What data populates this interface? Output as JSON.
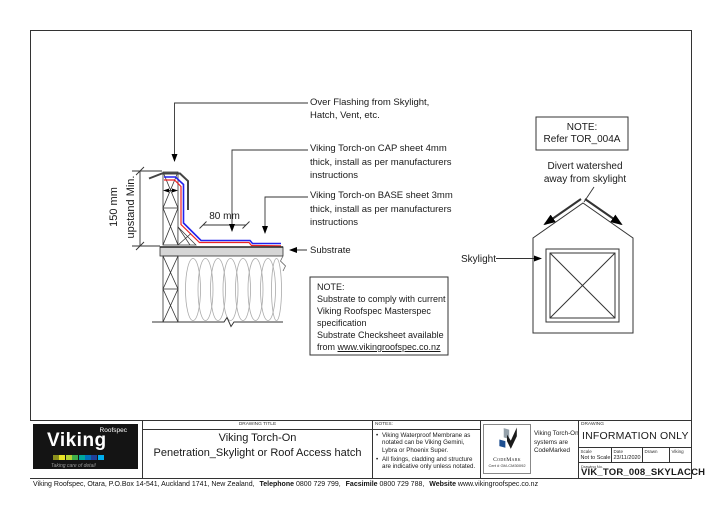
{
  "colors": {
    "cap_sheet": "#2222ee",
    "base_sheet": "#ee2222",
    "substrate": "#d6d6d6",
    "logo_bg": "#141414"
  },
  "section": {
    "dim_150": "150 mm",
    "dim_150_label": "upstand Min.",
    "dim_80": "80 mm",
    "ann_over_flashing": "Over Flashing from Skylight,\nHatch, Vent, etc.",
    "ann_cap": "Viking Torch-on CAP sheet 4mm\nthick, install as per manufacturers\ninstructions",
    "ann_base": "Viking Torch-on BASE sheet 3mm\nthick, install as per manufacturers\ninstructions",
    "ann_substrate": "Substrate",
    "note_box": {
      "body": "NOTE:\nSubstrate to comply with current\nViking Roofspec Masterspec\nspecification\nSubstrate Checksheet available",
      "last_line_prefix": "from ",
      "last_line_url": "www.vikingroofspec.co.nz"
    }
  },
  "plan": {
    "note_title": "NOTE:",
    "note_ref": "Refer TOR_004A",
    "divert": "Divert watershed\naway from skylight",
    "skylight_label": "Skylight"
  },
  "titleblock": {
    "logo": {
      "brand": "Viking",
      "sub": "Roofspec",
      "tagline": "Taking care of detail",
      "strip_colors": [
        "#8a8f1d",
        "#e8e427",
        "#b5d334",
        "#3fae49",
        "#00a79b",
        "#0071bc",
        "#21409a",
        "#00aeef"
      ]
    },
    "drawing_title_label": "DRAWING TITLE",
    "title_line1": "Viking Torch-On",
    "title_line2": "Penetration_Skylight or Roof Access hatch",
    "notes_label": "NOTES:",
    "notes": [
      "Viking Waterproof Membrane as notated can be Viking Gemini, Lybra or Phoenix Super.",
      "All fixings, cladding and structure are indicative only unless notated."
    ],
    "codemark": {
      "name": "CodeMark",
      "cert": "Cert # GM-CM30092",
      "side_text": "Viking Torch-On\nsystems are\nCodeMarked"
    },
    "drawing_label": "DRAWING",
    "info_only": "INFORMATION ONLY",
    "mini_cells": [
      {
        "label": "Scale",
        "value": "Not to Scale"
      },
      {
        "label": "Date",
        "value": "23/11/2020"
      },
      {
        "label": "Drawn",
        "value": ""
      },
      {
        "label": "Viking",
        "value": ""
      }
    ],
    "dwg_no_label": "Drawing No.",
    "dwg_no": "VIK_TOR_008_SKYLACCH"
  },
  "footer": {
    "address": "Viking Roofspec, Otara, P.O.Box 14-541, Auckland 1741, New Zealand,",
    "phone_label": "Telephone",
    "phone": "0800 729 799,",
    "fax_label": "Facsimile",
    "fax": "0800 729 788,",
    "website_label": "Website",
    "website": "www.vikingroofspec.co.nz"
  }
}
